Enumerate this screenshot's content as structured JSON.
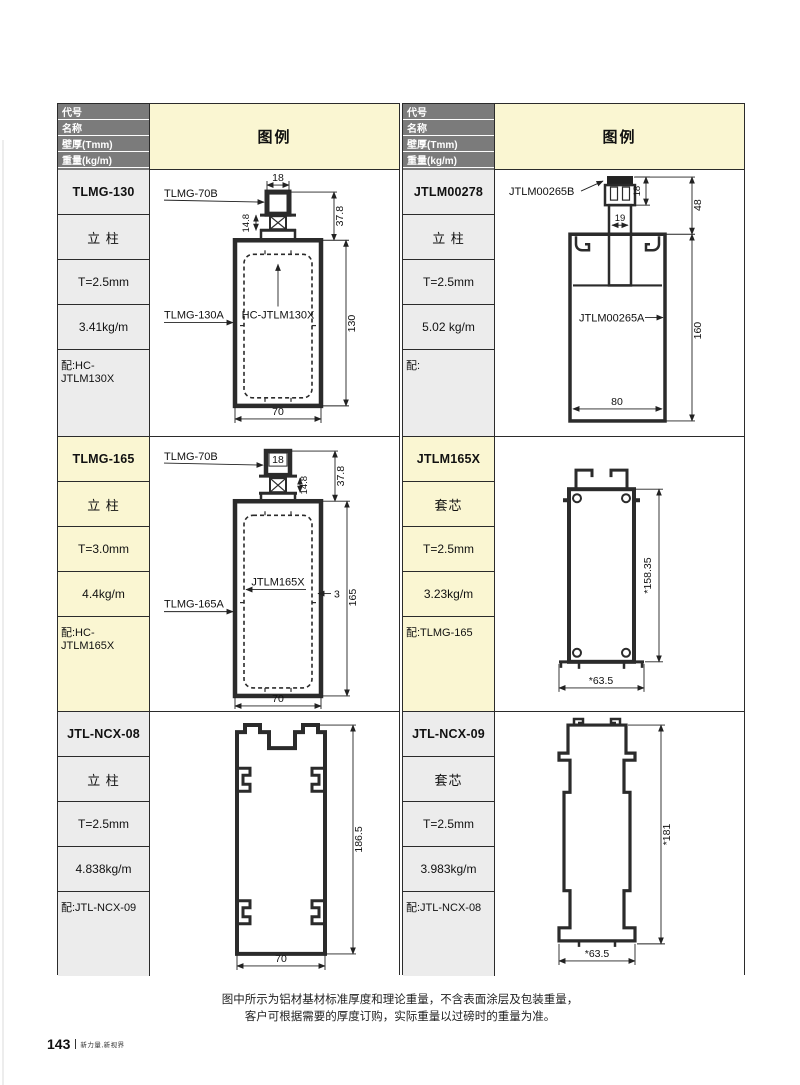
{
  "header": {
    "rows": [
      "代号",
      "名称",
      "壁厚(Tmm)",
      "重量(kg/m)",
      "配套"
    ],
    "legend": "图例"
  },
  "profiles": [
    {
      "code": "TLMG-130",
      "name": "立 柱",
      "thickness": "T=2.5mm",
      "weight": "3.41kg/m",
      "match": "配:HC-JTLM130X",
      "diagram": {
        "part_top": "TLMG-70B",
        "dim_top_width": "18",
        "dim_cap_height": "37.8",
        "dim_stem": "14.8",
        "part_insert": "HC-JTLM130X",
        "part_body": "TLMG-130A",
        "dim_height": "130",
        "dim_width": "70"
      }
    },
    {
      "code": "JTLM00278",
      "name": "立 柱",
      "thickness": "T=2.5mm",
      "weight": "5.02 kg/m",
      "match": "配:",
      "diagram": {
        "part_top": "JTLM00265B",
        "dim_clamp": "18",
        "dim_cap_height": "48",
        "dim_stem": "19",
        "part_body": "JTLM00265A",
        "dim_height": "160",
        "dim_width": "80"
      }
    },
    {
      "code": "TLMG-165",
      "name": "立 柱",
      "thickness": "T=3.0mm",
      "weight": "4.4kg/m",
      "match": "配:HC-JTLM165X",
      "diagram": {
        "part_top": "TLMG-70B",
        "dim_top_width": "18",
        "dim_cap_height": "37.8",
        "dim_stem": "14.8",
        "part_insert": "JTLM165X",
        "dim_wall": "3",
        "part_body": "TLMG-165A",
        "dim_height": "165",
        "dim_width": "70"
      }
    },
    {
      "code": "JTLM165X",
      "name": "套芯",
      "thickness": "T=2.5mm",
      "weight": "3.23kg/m",
      "match": "配:TLMG-165",
      "diagram": {
        "dim_height": "*158.35",
        "dim_width": "*63.5"
      }
    },
    {
      "code": "JTL-NCX-08",
      "name": "立 柱",
      "thickness": "T=2.5mm",
      "weight": "4.838kg/m",
      "match": "配:JTL-NCX-09",
      "diagram": {
        "dim_height": "186.5",
        "dim_width": "70"
      }
    },
    {
      "code": "JTL-NCX-09",
      "name": "套芯",
      "thickness": "T=2.5mm",
      "weight": "3.983kg/m",
      "match": "配:JTL-NCX-08",
      "diagram": {
        "dim_height": "*181",
        "dim_width": "*63.5"
      }
    }
  ],
  "footer": {
    "note_line1": "图中所示为铝材基材标准厚度和理论重量，不含表面涂层及包装重量，",
    "note_line2": "客户可根据需要的厚度订购，实际重量以过磅时的重量为准。",
    "page_number": "143",
    "slogan": "新力量,新视界"
  },
  "colors": {
    "header_gray": "#7b7b7b",
    "highlight_yellow": "#faf6d2",
    "row_gray": "#ececec",
    "line": "#2b2b2b"
  }
}
